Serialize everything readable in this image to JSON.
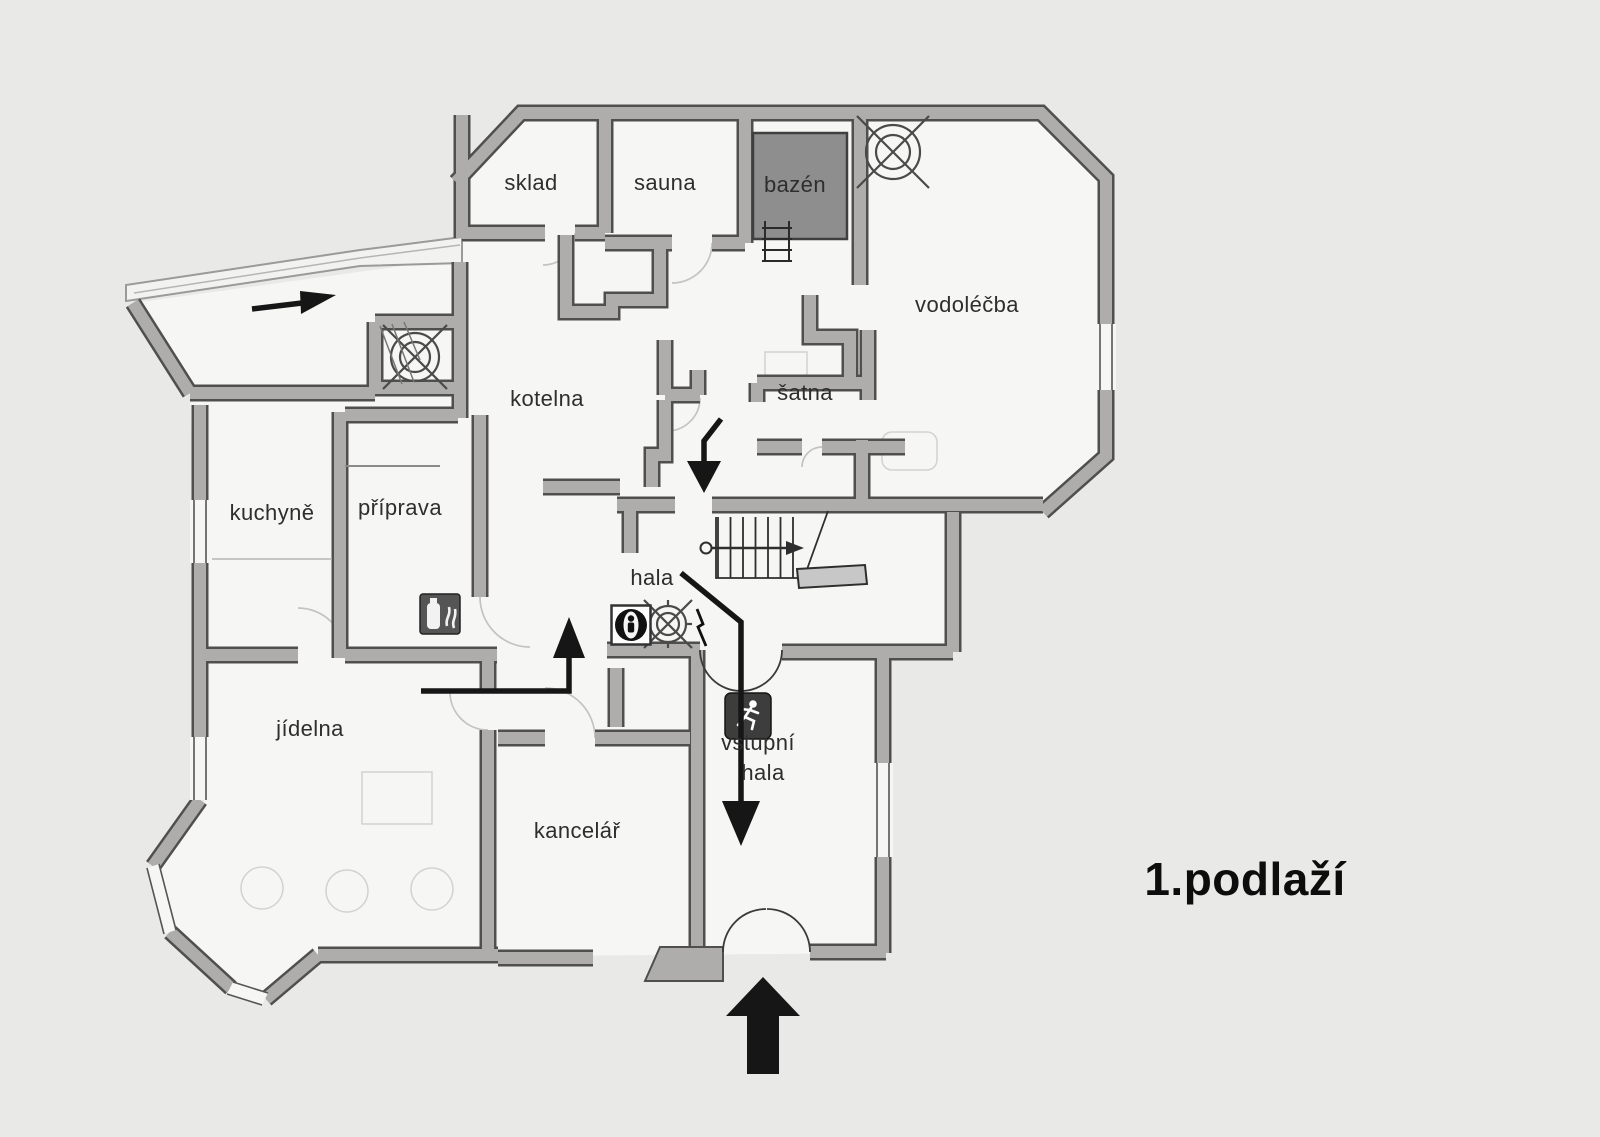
{
  "floor": {
    "title": "1.podlaží"
  },
  "rooms": {
    "sklad": {
      "label": "sklad"
    },
    "sauna": {
      "label": "sauna"
    },
    "bazen": {
      "label": "bazén"
    },
    "vodolecba": {
      "label": "vodoléčba"
    },
    "kotelna": {
      "label": "kotelna"
    },
    "satna": {
      "label": "šatna"
    },
    "kuchyne": {
      "label": "kuchyně"
    },
    "priprava": {
      "label": "příprava"
    },
    "hala": {
      "label": "hala"
    },
    "jidelna": {
      "label": "jídelna"
    },
    "kancelar": {
      "label": "kancelář"
    },
    "vstupni_hala": {
      "line1": "vstupní",
      "line2": "hala"
    }
  },
  "icons": {
    "fan_top_right": "ventilation-fan-symbol",
    "fan_shaft": "ventilation-fan-symbol",
    "fan_hala": "ventilation-fan-symbol",
    "hydrant": "person-in-circle-hydrant-symbol",
    "lightning": "electrical-lightning-symbol",
    "running_man": "emergency-exit-running-man",
    "fire_extinguisher": "fire-extinguisher-symbol",
    "stairs": "staircase-with-up-arrow",
    "pool_ladder": "pool-ladder",
    "entry_arrows": "entrance-direction-arrows",
    "escape_route": "escape-route-arrows"
  },
  "colors": {
    "background": "#e9e9e8",
    "paper": "#f6f6f4",
    "wall_fill": "#aeadac",
    "wall_edge": "#4f4f4f",
    "pool_fill": "#8e8e8e",
    "route_black": "#161616"
  }
}
